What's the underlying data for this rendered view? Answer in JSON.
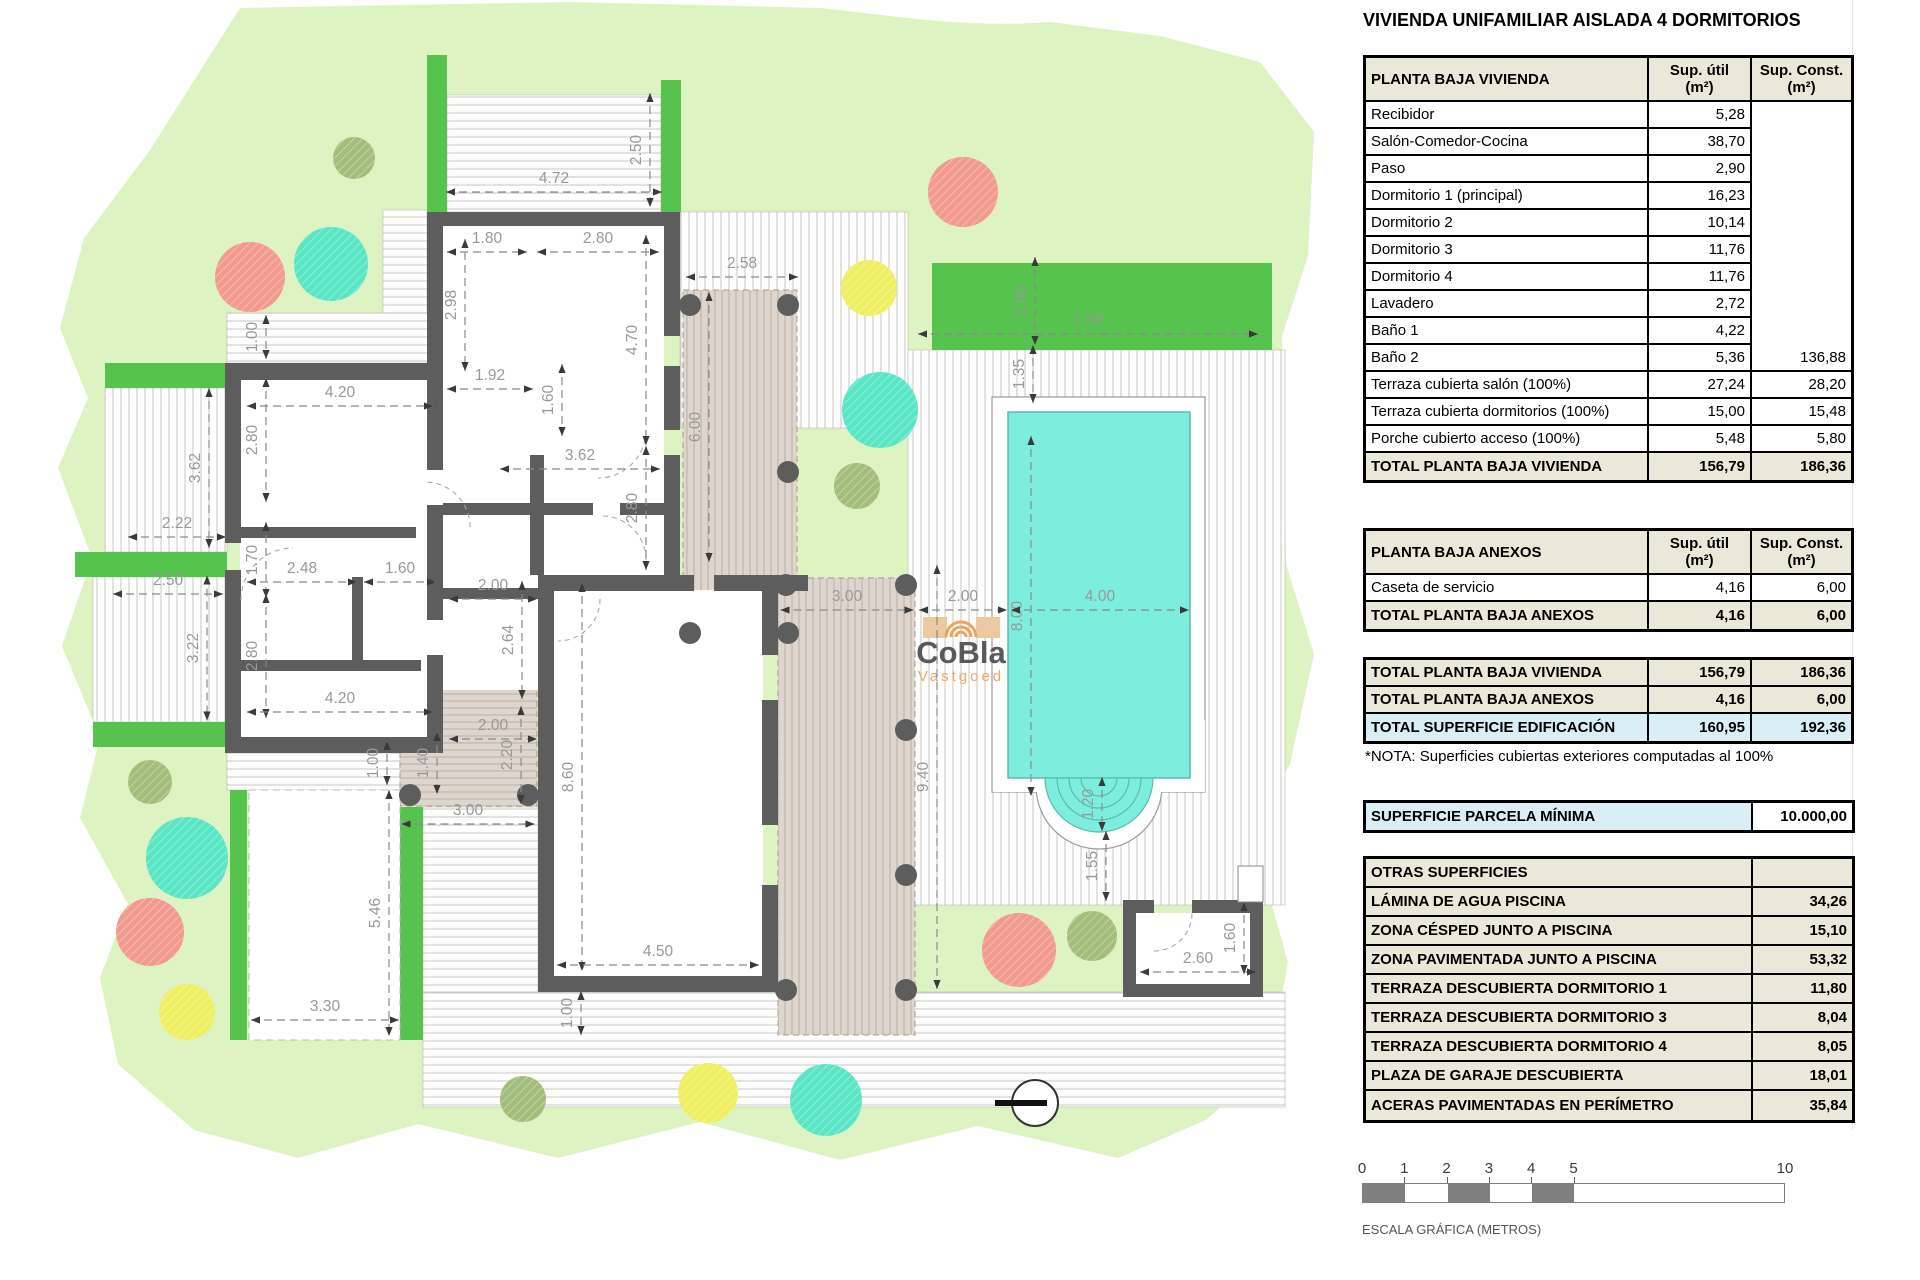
{
  "title": "VIVIENDA UNIFAMILIAR AISLADA 4 DORMITORIOS",
  "vivienda": {
    "title": "PLANTA BAJA VIVIENDA",
    "col_util": "Sup. útil\n(m²)",
    "col_const": "Sup. Const.\n(m²)",
    "rows": [
      [
        "Recibidor",
        "5,28",
        ""
      ],
      [
        "Salón-Comedor-Cocina",
        "38,70",
        ""
      ],
      [
        "Paso",
        "2,90",
        ""
      ],
      [
        "Dormitorio 1 (principal)",
        "16,23",
        ""
      ],
      [
        "Dormitorio 2",
        "10,14",
        ""
      ],
      [
        "Dormitorio 3",
        "11,76",
        ""
      ],
      [
        "Dormitorio 4",
        "11,76",
        ""
      ],
      [
        "Lavadero",
        "2,72",
        ""
      ],
      [
        "Baño 1",
        "4,22",
        ""
      ],
      [
        "Baño 2",
        "5,36",
        "136,88"
      ],
      [
        "Terraza cubierta salón (100%)",
        "27,24",
        "28,20"
      ],
      [
        "Terraza cubierta dormitorios (100%)",
        "15,00",
        "15,48"
      ],
      [
        "Porche cubierto acceso (100%)",
        "5,48",
        "5,80"
      ]
    ],
    "total": [
      "TOTAL PLANTA BAJA VIVIENDA",
      "156,79",
      "186,36"
    ]
  },
  "anexos": {
    "title": "PLANTA BAJA ANEXOS",
    "col_util": "Sup. útil\n(m²)",
    "col_const": "Sup. Const.\n(m²)",
    "rows": [
      [
        "Caseta de servicio",
        "4,16",
        "6,00"
      ]
    ],
    "total": [
      "TOTAL PLANTA BAJA ANEXOS",
      "4,16",
      "6,00"
    ]
  },
  "resumen": {
    "rows": [
      [
        "TOTAL PLANTA BAJA VIVIENDA",
        "156,79",
        "186,36",
        "beige"
      ],
      [
        "TOTAL PLANTA BAJA ANEXOS",
        "4,16",
        "6,00",
        "beige"
      ],
      [
        "TOTAL SUPERFICIE EDIFICACIÓN",
        "160,95",
        "192,36",
        "blue"
      ]
    ]
  },
  "nota": "*NOTA: Superficies cubiertas exteriores computadas al 100%",
  "parcela": {
    "label": "SUPERFICIE PARCELA MÍNIMA",
    "value": "10.000,00"
  },
  "otras": {
    "title": "OTRAS SUPERFICIES",
    "rows": [
      [
        "LÁMINA DE AGUA PISCINA",
        "34,26"
      ],
      [
        "ZONA CÉSPED JUNTO A PISCINA",
        "15,10"
      ],
      [
        "ZONA PAVIMENTADA JUNTO A PISCINA",
        "53,32"
      ],
      [
        "TERRAZA DESCUBIERTA DORMITORIO 1",
        "11,80"
      ],
      [
        "TERRAZA DESCUBIERTA DORMITORIO 3",
        "8,04"
      ],
      [
        "TERRAZA DESCUBIERTA DORMITORIO 4",
        "8,05"
      ],
      [
        "PLAZA DE GARAJE DESCUBIERTA",
        "18,01"
      ],
      [
        "ACERAS PAVIMENTADAS EN PERÍMETRO",
        "35,84"
      ]
    ]
  },
  "scalebar": {
    "ticks": [
      "0",
      "1",
      "2",
      "3",
      "4",
      "5"
    ],
    "end_tick": "10",
    "caption": "ESCALA GRÁFICA (METROS)"
  },
  "logo": {
    "name": "CoBla",
    "subtitle": "Vastgoed"
  },
  "plan": {
    "colors": {
      "garden": "#ddf3c2",
      "hedge": "#55c34d",
      "wall": "#5d5d5d",
      "pool": "#7deddd",
      "pool_edge": "#5bbcac",
      "beige_terrace": "#ddd5ce",
      "stripe": "#c4c4bc",
      "tree_salmon": "#f29a8e",
      "tree_teal": "#59e6c5",
      "tree_yellow": "#eef062",
      "tree_olive": "#a3bd7a",
      "table_beige": "#eae9d9",
      "table_blue": "#d9eef5"
    },
    "dims": [
      {
        "t": "2.50",
        "x": 641,
        "y": 150,
        "a": "v",
        "len": 114
      },
      {
        "t": "4.72",
        "x": 554,
        "y": 183,
        "a": "h",
        "len": 216
      },
      {
        "t": "1.80",
        "x": 487,
        "y": 243,
        "a": "h",
        "len": 80
      },
      {
        "t": "2.80",
        "x": 598,
        "y": 243,
        "a": "h",
        "len": 122
      },
      {
        "t": "2.58",
        "x": 742,
        "y": 268,
        "a": "h",
        "len": 112
      },
      {
        "t": "2.98",
        "x": 456,
        "y": 305,
        "a": "v",
        "len": 132
      },
      {
        "t": "4.70",
        "x": 637,
        "y": 340,
        "a": "v",
        "len": 210
      },
      {
        "t": "1.00",
        "x": 257,
        "y": 337,
        "a": "v",
        "len": 44
      },
      {
        "t": "4.20",
        "x": 340,
        "y": 397,
        "a": "h",
        "len": 186
      },
      {
        "t": "1.92",
        "x": 490,
        "y": 380,
        "a": "h",
        "len": 86
      },
      {
        "t": "1.60",
        "x": 553,
        "y": 400,
        "a": "v",
        "len": 72
      },
      {
        "t": "3.62",
        "x": 580,
        "y": 460,
        "a": "h",
        "len": 160
      },
      {
        "t": "2.80",
        "x": 637,
        "y": 508,
        "a": "v",
        "len": 124
      },
      {
        "t": "6.00",
        "x": 700,
        "y": 427,
        "a": "v",
        "len": 270
      },
      {
        "t": "2.80",
        "x": 257,
        "y": 440,
        "a": "v",
        "len": 124
      },
      {
        "t": "3.62",
        "x": 200,
        "y": 468,
        "a": "v",
        "len": 160
      },
      {
        "t": "2.22",
        "x": 177,
        "y": 528,
        "a": "h",
        "len": 98
      },
      {
        "t": "1.70",
        "x": 257,
        "y": 560,
        "a": "v",
        "len": 76
      },
      {
        "t": "2.48",
        "x": 302,
        "y": 573,
        "a": "h",
        "len": 110
      },
      {
        "t": "1.60",
        "x": 400,
        "y": 573,
        "a": "h",
        "len": 72
      },
      {
        "t": "2.50",
        "x": 168,
        "y": 585,
        "a": "h",
        "len": 110
      },
      {
        "t": "3.22",
        "x": 198,
        "y": 648,
        "a": "v",
        "len": 145
      },
      {
        "t": "2.80",
        "x": 257,
        "y": 656,
        "a": "v",
        "len": 124
      },
      {
        "t": "4.20",
        "x": 340,
        "y": 703,
        "a": "h",
        "len": 186
      },
      {
        "t": "2.00",
        "x": 493,
        "y": 590,
        "a": "h",
        "len": 88
      },
      {
        "t": "2.64",
        "x": 513,
        "y": 640,
        "a": "v",
        "len": 118
      },
      {
        "t": "2.00",
        "x": 493,
        "y": 730,
        "a": "h",
        "len": 88
      },
      {
        "t": "1.40",
        "x": 428,
        "y": 763,
        "a": "v",
        "len": 62
      },
      {
        "t": "2.20",
        "x": 512,
        "y": 755,
        "a": "v",
        "len": 98
      },
      {
        "t": "1.00",
        "x": 378,
        "y": 763,
        "a": "v",
        "len": 44
      },
      {
        "t": "3.00",
        "x": 468,
        "y": 815,
        "a": "h",
        "len": 133
      },
      {
        "t": "8.60",
        "x": 573,
        "y": 777,
        "a": "v",
        "len": 388
      },
      {
        "t": "5.46",
        "x": 380,
        "y": 913,
        "a": "v",
        "len": 246
      },
      {
        "t": "3.30",
        "x": 325,
        "y": 1011,
        "a": "h",
        "len": 148
      },
      {
        "t": "4.50",
        "x": 658,
        "y": 956,
        "a": "h",
        "len": 202
      },
      {
        "t": "1.00",
        "x": 572,
        "y": 1013,
        "a": "v",
        "len": 44
      },
      {
        "t": "9.40",
        "x": 928,
        "y": 777,
        "a": "v",
        "len": 424
      },
      {
        "t": "3.00",
        "x": 847,
        "y": 601,
        "a": "h",
        "len": 133
      },
      {
        "t": "2.00",
        "x": 963,
        "y": 601,
        "a": "h",
        "len": 88
      },
      {
        "t": "8.00",
        "x": 1022,
        "y": 616,
        "a": "v",
        "len": 360
      },
      {
        "t": "4.00",
        "x": 1100,
        "y": 601,
        "a": "h",
        "len": 178
      },
      {
        "t": "7.55",
        "x": 1088,
        "y": 325,
        "a": "h",
        "len": 340
      },
      {
        "t": "2.00",
        "x": 1026,
        "y": 301,
        "a": "v",
        "len": 88
      },
      {
        "t": "1.35",
        "x": 1024,
        "y": 374,
        "a": "v",
        "len": 58
      },
      {
        "t": "1.20",
        "x": 1093,
        "y": 804,
        "a": "v",
        "len": 54
      },
      {
        "t": "1.55",
        "x": 1097,
        "y": 866,
        "a": "v",
        "len": 70
      },
      {
        "t": "2.60",
        "x": 1198,
        "y": 963,
        "a": "h",
        "len": 116
      },
      {
        "t": "1.60",
        "x": 1235,
        "y": 938,
        "a": "v",
        "len": 72
      }
    ],
    "trees": [
      {
        "x": 354,
        "y": 158,
        "r": 21,
        "c": "tree_olive"
      },
      {
        "x": 250,
        "y": 277,
        "r": 35,
        "c": "tree_salmon"
      },
      {
        "x": 331,
        "y": 264,
        "r": 37,
        "c": "tree_teal"
      },
      {
        "x": 963,
        "y": 192,
        "r": 35,
        "c": "tree_salmon"
      },
      {
        "x": 869,
        "y": 288,
        "r": 28,
        "c": "tree_yellow"
      },
      {
        "x": 880,
        "y": 410,
        "r": 38,
        "c": "tree_teal"
      },
      {
        "x": 857,
        "y": 486,
        "r": 23,
        "c": "tree_olive"
      },
      {
        "x": 150,
        "y": 782,
        "r": 22,
        "c": "tree_olive"
      },
      {
        "x": 187,
        "y": 858,
        "r": 41,
        "c": "tree_teal"
      },
      {
        "x": 150,
        "y": 932,
        "r": 34,
        "c": "tree_salmon"
      },
      {
        "x": 187,
        "y": 1012,
        "r": 28,
        "c": "tree_yellow"
      },
      {
        "x": 523,
        "y": 1099,
        "r": 23,
        "c": "tree_olive"
      },
      {
        "x": 708,
        "y": 1093,
        "r": 30,
        "c": "tree_yellow"
      },
      {
        "x": 826,
        "y": 1100,
        "r": 36,
        "c": "tree_teal"
      },
      {
        "x": 1019,
        "y": 950,
        "r": 37,
        "c": "tree_salmon"
      },
      {
        "x": 1092,
        "y": 936,
        "r": 25,
        "c": "tree_olive"
      }
    ]
  }
}
